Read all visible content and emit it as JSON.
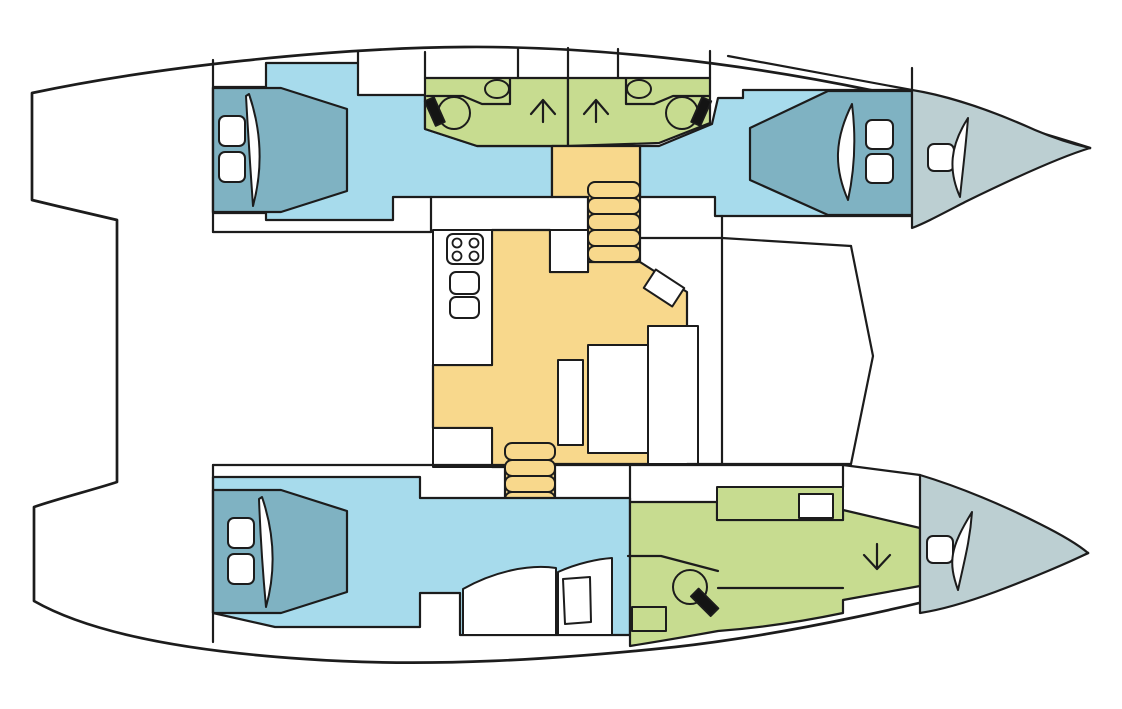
{
  "diagram": {
    "type": "catamaran-interior-deck-plan",
    "view": "top-down",
    "bow_direction": "right",
    "palette": {
      "line": "#1c1c1c",
      "background": "#ffffff",
      "cabin_floor": "#a7dbec",
      "berth": "#7fb2c2",
      "bathroom": "#c7dc90",
      "saloon_galley": "#f8d88c",
      "forepeak_berth": "#bccfd2",
      "fixture_white": "#ffffff",
      "fixture_black": "#141414"
    },
    "areas": {
      "port_hull": {
        "aft_cabin": {
          "kind": "double-cabin",
          "items": [
            "double-berth",
            "pillow",
            "pillow",
            "duvet-fold"
          ]
        },
        "aft_bathroom": {
          "kind": "bathroom",
          "items": [
            "toilet",
            "washbasin",
            "vanity-counter"
          ],
          "companionway": "up-arrow"
        },
        "forward_bathroom": {
          "kind": "bathroom",
          "items": [
            "toilet",
            "washbasin",
            "vanity-counter"
          ],
          "companionway": "up-arrow"
        },
        "forward_cabin": {
          "kind": "double-cabin",
          "items": [
            "double-berth",
            "pillow",
            "pillow",
            "duvet-fold"
          ]
        },
        "forepeak": {
          "kind": "bow-berth",
          "items": [
            "hatch-cushion",
            "duvet-fold"
          ]
        }
      },
      "bridge_deck": {
        "saloon_galley": {
          "kind": "saloon-galley",
          "items": [
            "stove-4-burner",
            "galley-sink",
            "galley-sink",
            "galley-counter",
            "island-counter",
            "cabinet",
            "nav-seat",
            "saloon-table",
            "bench",
            "bench"
          ],
          "stairs": {
            "to_port_hull_steps": 5,
            "to_starboard_hull_steps": 4
          }
        }
      },
      "starboard_hull": {
        "aft_cabin": {
          "kind": "double-cabin",
          "items": [
            "double-berth",
            "pillow",
            "pillow",
            "duvet-fold",
            "seat",
            "seat",
            "side-table"
          ]
        },
        "owner_bathroom": {
          "kind": "bathroom",
          "items": [
            "toilet",
            "vanity-counter",
            "counter-with-basin",
            "cabinet"
          ],
          "companionway": "down-arrow"
        },
        "forepeak": {
          "kind": "bow-berth",
          "items": [
            "hatch-cushion",
            "duvet-fold"
          ]
        }
      }
    }
  }
}
